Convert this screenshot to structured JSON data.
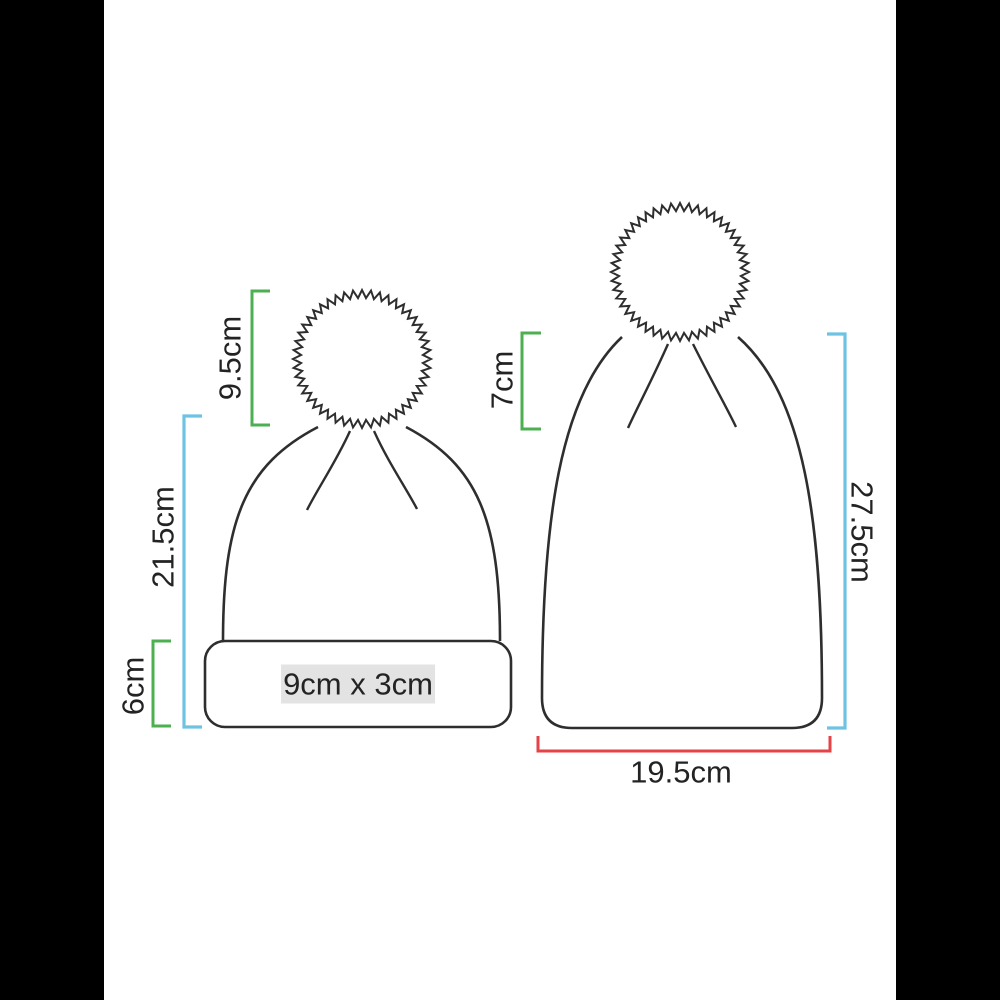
{
  "colors": {
    "green": "#4caf50",
    "blue": "#6ec3e3",
    "red": "#e54345",
    "outline": "#2e2e2e",
    "highlight": "#e3e3e3",
    "text": "#232323",
    "bar": "#000000"
  },
  "left_beanie": {
    "pom_height": "9.5cm",
    "body_height": "21.5cm",
    "cuff_height": "6cm",
    "print_area": "9cm x 3cm"
  },
  "right_beanie": {
    "crown_height": "7cm",
    "body_height": "27.5cm",
    "width": "19.5cm"
  }
}
